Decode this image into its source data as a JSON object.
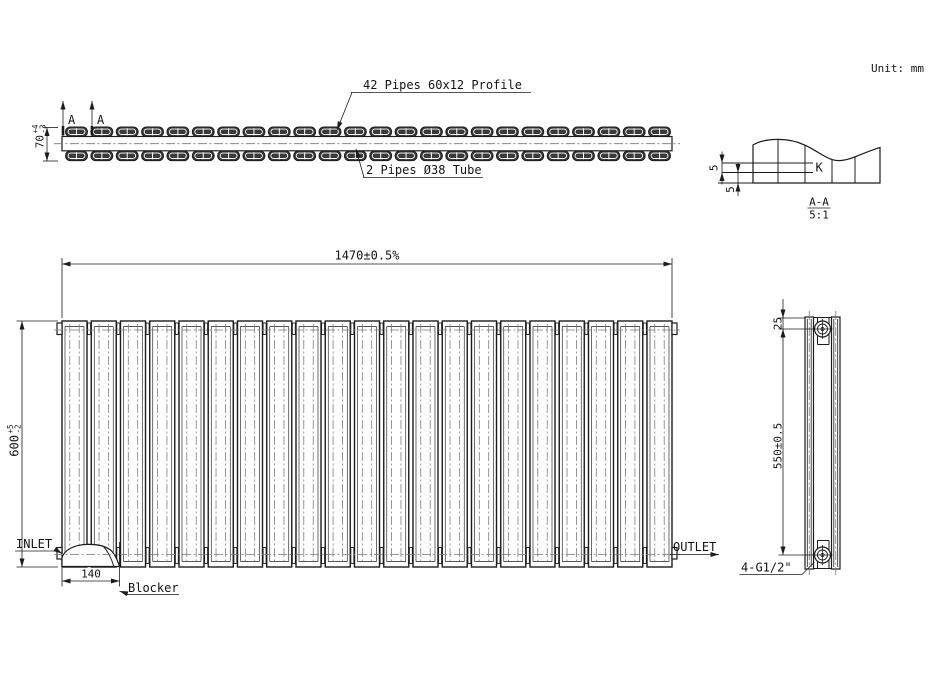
{
  "header": {
    "unit_label": "Unit: mm"
  },
  "top_view": {
    "pipes_label": "42 Pipes 60x12 Profile",
    "tube_label": "2 Pipes Ø38 Tube",
    "section_letter": "A",
    "height_dim": {
      "value": "70",
      "tol_plus": "+4",
      "tol_minus": "-3"
    }
  },
  "section_view": {
    "title": "A-A",
    "scale": "5:1",
    "strip_label": "K",
    "strip_thickness_dim": "5",
    "strip_offset_dim": "5"
  },
  "front_view": {
    "width_dim": "1470±0.5%",
    "height_dim": {
      "value": "600",
      "tol_plus": "+5",
      "tol_minus": "-2"
    },
    "inlet_label": "INLET",
    "outlet_label": "OUTLET",
    "blocker_width_dim": "140",
    "blocker_label": "Blocker"
  },
  "side_view": {
    "top_offset_dim": "25",
    "connection_spacing_dim": "550±0.5",
    "thread_label": "4-G1/2\""
  },
  "drawing": {
    "line_color": "#1c1c1c",
    "pill_fill": "#3a3a3a",
    "pills": {
      "x0": 65.5,
      "pitch": 25.35,
      "count": 24,
      "w": 22,
      "h": 9.6,
      "rows": [
        127,
        151
      ]
    },
    "panels": {
      "x0": 62,
      "pitch": 29.25,
      "count": 21,
      "w": 25,
      "top": 321,
      "bottom": 567
    },
    "arrows": [
      [
        62,
        264,
        0
      ],
      [
        672,
        264,
        180
      ],
      [
        22,
        321,
        90
      ],
      [
        22,
        567,
        -90
      ],
      [
        47,
        127.5,
        90
      ],
      [
        47,
        161,
        -90
      ],
      [
        62,
        581,
        0
      ],
      [
        119.5,
        581,
        180
      ],
      [
        63,
        101,
        90
      ],
      [
        92,
        101,
        90
      ],
      [
        337,
        130,
        -68.5
      ],
      [
        356,
        149,
        74
      ],
      [
        62,
        553.5,
        -148
      ],
      [
        719,
        554.5,
        180
      ],
      [
        119.5,
        591,
        19
      ],
      [
        783,
        318,
        -90
      ],
      [
        783,
        329,
        90
      ],
      [
        783,
        555,
        -90
      ],
      [
        722,
        163,
        -90
      ],
      [
        722,
        172.5,
        90
      ],
      [
        738,
        172.5,
        -90
      ],
      [
        738,
        183,
        90
      ]
    ]
  }
}
